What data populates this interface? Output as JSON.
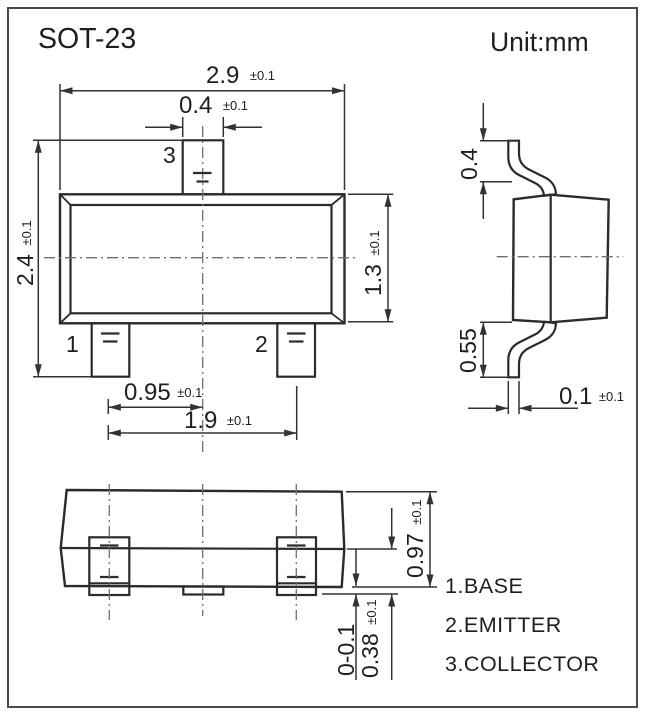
{
  "title": "SOT-23",
  "unit_label": "Unit:mm",
  "pins": {
    "pin1": "1",
    "pin2": "2",
    "pin3": "3"
  },
  "legend": [
    "1.BASE",
    "2.EMITTER",
    "3.COLLECTOR"
  ],
  "dimensions": {
    "body_width": {
      "value": "2.9",
      "tol": "±0.1"
    },
    "pin3_width": {
      "value": "0.4",
      "tol": "±0.1"
    },
    "overall_depth": {
      "value": "2.4",
      "tol": "±0.1"
    },
    "body_depth": {
      "value": "1.3",
      "tol": "±0.1"
    },
    "pin_pitch": {
      "value": "0.95",
      "tol": "±0.1"
    },
    "pin_span": {
      "value": "1.9",
      "tol": "±0.1"
    },
    "lead_top_length": {
      "value": "0.4",
      "tol": ""
    },
    "lead_bottom_length": {
      "value": "0.55",
      "tol": ""
    },
    "lead_thickness": {
      "value": "0.1",
      "tol": "±0.1"
    },
    "package_height": {
      "value": "0.97",
      "tol": "±0.1"
    },
    "standoff": {
      "value": "0-0.1",
      "tol": ""
    },
    "lead_foot_height": {
      "value": "0.38",
      "tol": "±0.1"
    }
  },
  "colors": {
    "background": "#ffffff",
    "outline": "#2b2b2b",
    "dimension_line": "#333333",
    "centerline": "#6e6e6e",
    "text": "#1e1e1e",
    "page_border": "#4a4a4a"
  }
}
